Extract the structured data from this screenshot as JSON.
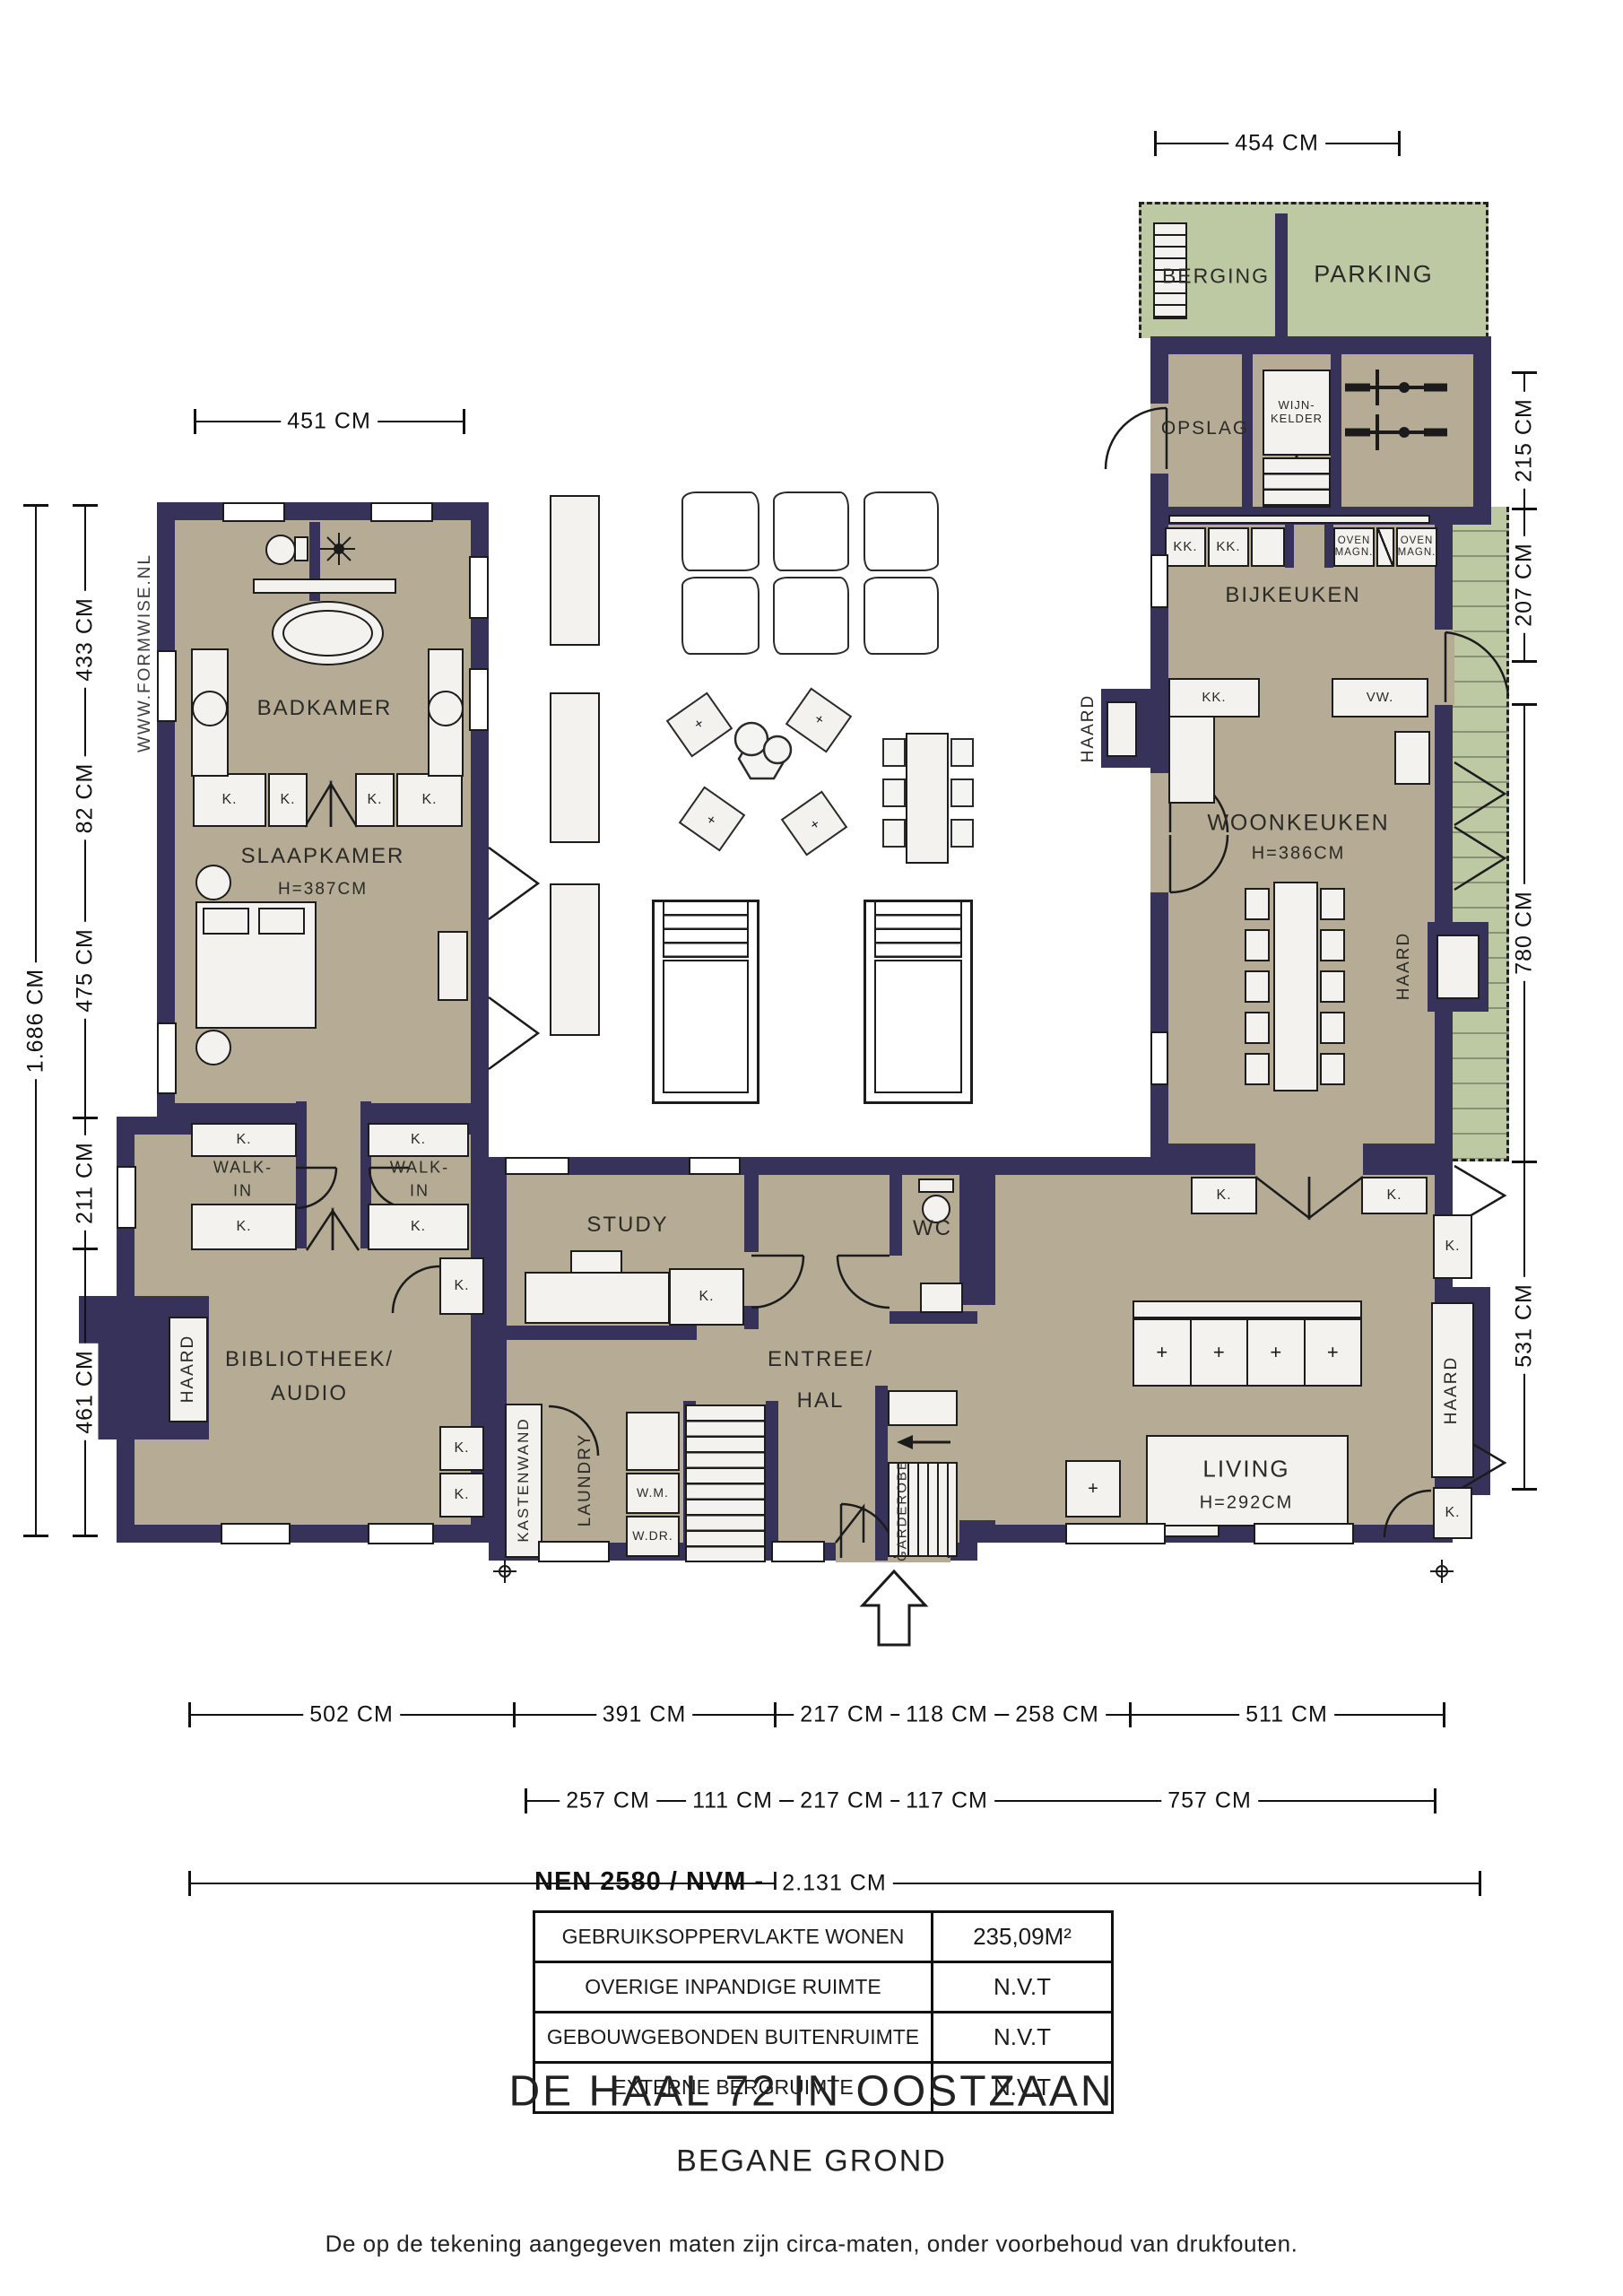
{
  "watermark": "WWW.FORMWISE.NL",
  "labels": {
    "badkamer": "BADKAMER",
    "slaapkamer": "SLAAPKAMER",
    "slaapkamer_h": "H=387CM",
    "walkin1": "WALK-",
    "walkin2": "IN",
    "bibliotheek1": "BIBLIOTHEEK/",
    "bibliotheek2": "AUDIO",
    "study": "STUDY",
    "entree1": "ENTREE/",
    "entree2": "HAL",
    "wc": "WC",
    "kastenwand": "KASTENWAND",
    "laundry": "LAUNDRY",
    "wm": "W.M.",
    "wdr": "W.DR.",
    "garderobe": "GARDEROBE",
    "living": "LIVING",
    "living_h": "H=292CM",
    "woonkeuken": "WOONKEUKEN",
    "woonkeuken_h": "H=386CM",
    "bijkeuken": "BIJKEUKEN",
    "berging": "BERGING",
    "parking": "PARKING",
    "opslag": "OPSLAG",
    "wijnkelder1": "WIJN-",
    "wijnkelder2": "KELDER",
    "haard": "HAARD",
    "k": "K.",
    "kk": "KK.",
    "vw": "VW.",
    "oven1": "OVEN",
    "oven2": "MAGN."
  },
  "dimensions": {
    "top_left": "451 CM",
    "top_right": "454 CM",
    "left_total": "1.686 CM",
    "left_chain": [
      "433 CM",
      "82 CM",
      "475 CM",
      "211 CM",
      "461 CM"
    ],
    "right_chain": [
      "215 CM",
      "207 CM",
      "780 CM",
      "531 CM"
    ],
    "bottom_row1": [
      "502 CM",
      "391 CM",
      "217 CM",
      "118 CM",
      "258 CM",
      "511 CM"
    ],
    "bottom_row2": [
      "257 CM",
      "111 CM",
      "217 CM",
      "117 CM",
      "757 CM"
    ],
    "bottom_total": "2.131 CM"
  },
  "area_table": {
    "title": "NEN 2580 / NVM - BBMI",
    "rows": [
      {
        "label": "GEBRUIKSOPPERVLAKTE WONEN",
        "value": "235,09M²"
      },
      {
        "label": "OVERIGE INPANDIGE RUIMTE",
        "value": "N.V.T"
      },
      {
        "label": "GEBOUWGEBONDEN BUITENRUIMTE",
        "value": "N.V.T"
      },
      {
        "label": "EXTERNE BERGRUIMTE",
        "value": "N.V.T"
      }
    ]
  },
  "footer": {
    "title": "DE HAAL 72 IN OOSTZAAN",
    "subtitle": "BEGANE GROND",
    "disclaimer": "De op de tekening aangegeven maten zijn circa-maten, onder voorbehoud van drukfouten."
  },
  "colors": {
    "wall": "#37325a",
    "floor": "#b6ac95",
    "green": "#bdc9a3",
    "outline": "#1b1b1b"
  }
}
